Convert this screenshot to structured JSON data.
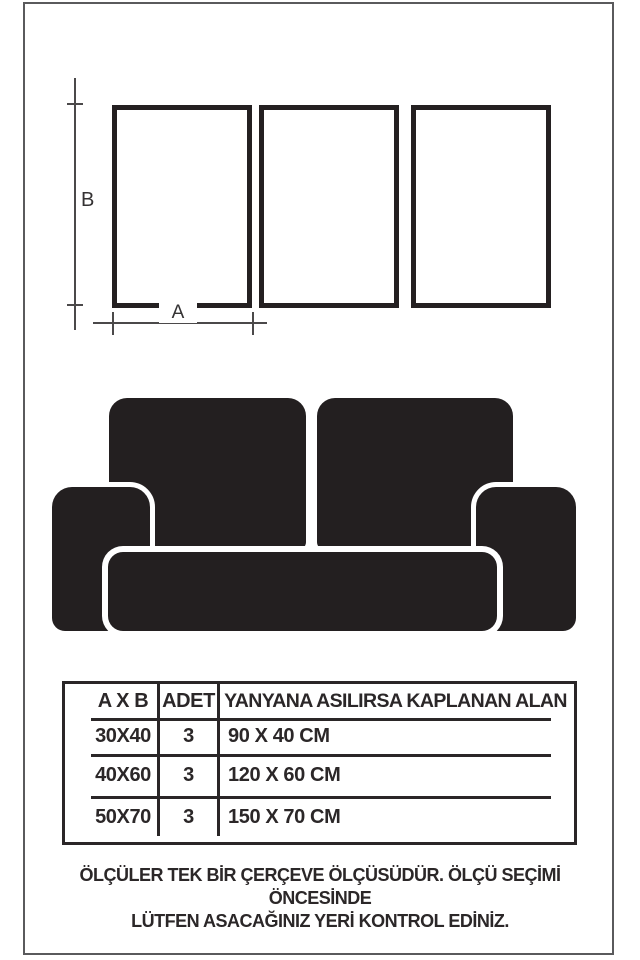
{
  "colors": {
    "ink_black": "#231f20",
    "table_line": "#2a2627",
    "dimension_line_gray": "#4b494a",
    "outer_border_gray": "#5a5a5c",
    "background": "#ffffff"
  },
  "diagram": {
    "frame_count": 3,
    "width_label": "A",
    "height_label": "B"
  },
  "table": {
    "columns": [
      "A X B",
      "ADET",
      "YANYANA ASILIRSA KAPLANAN ALAN"
    ],
    "rows": [
      [
        "30X40",
        "3",
        "90 X 40 CM"
      ],
      [
        "40X60",
        "3",
        "120 X 60 CM"
      ],
      [
        "50X70",
        "3",
        "150 X 70 CM"
      ]
    ]
  },
  "footer": {
    "line1": "ÖLÇÜLER TEK BİR ÇERÇEVE ÖLÇÜSÜDÜR. ÖLÇÜ SEÇİMİ ÖNCESİNDE",
    "line2": "LÜTFEN ASACAĞINIZ YERİ KONTROL EDİNİZ."
  }
}
